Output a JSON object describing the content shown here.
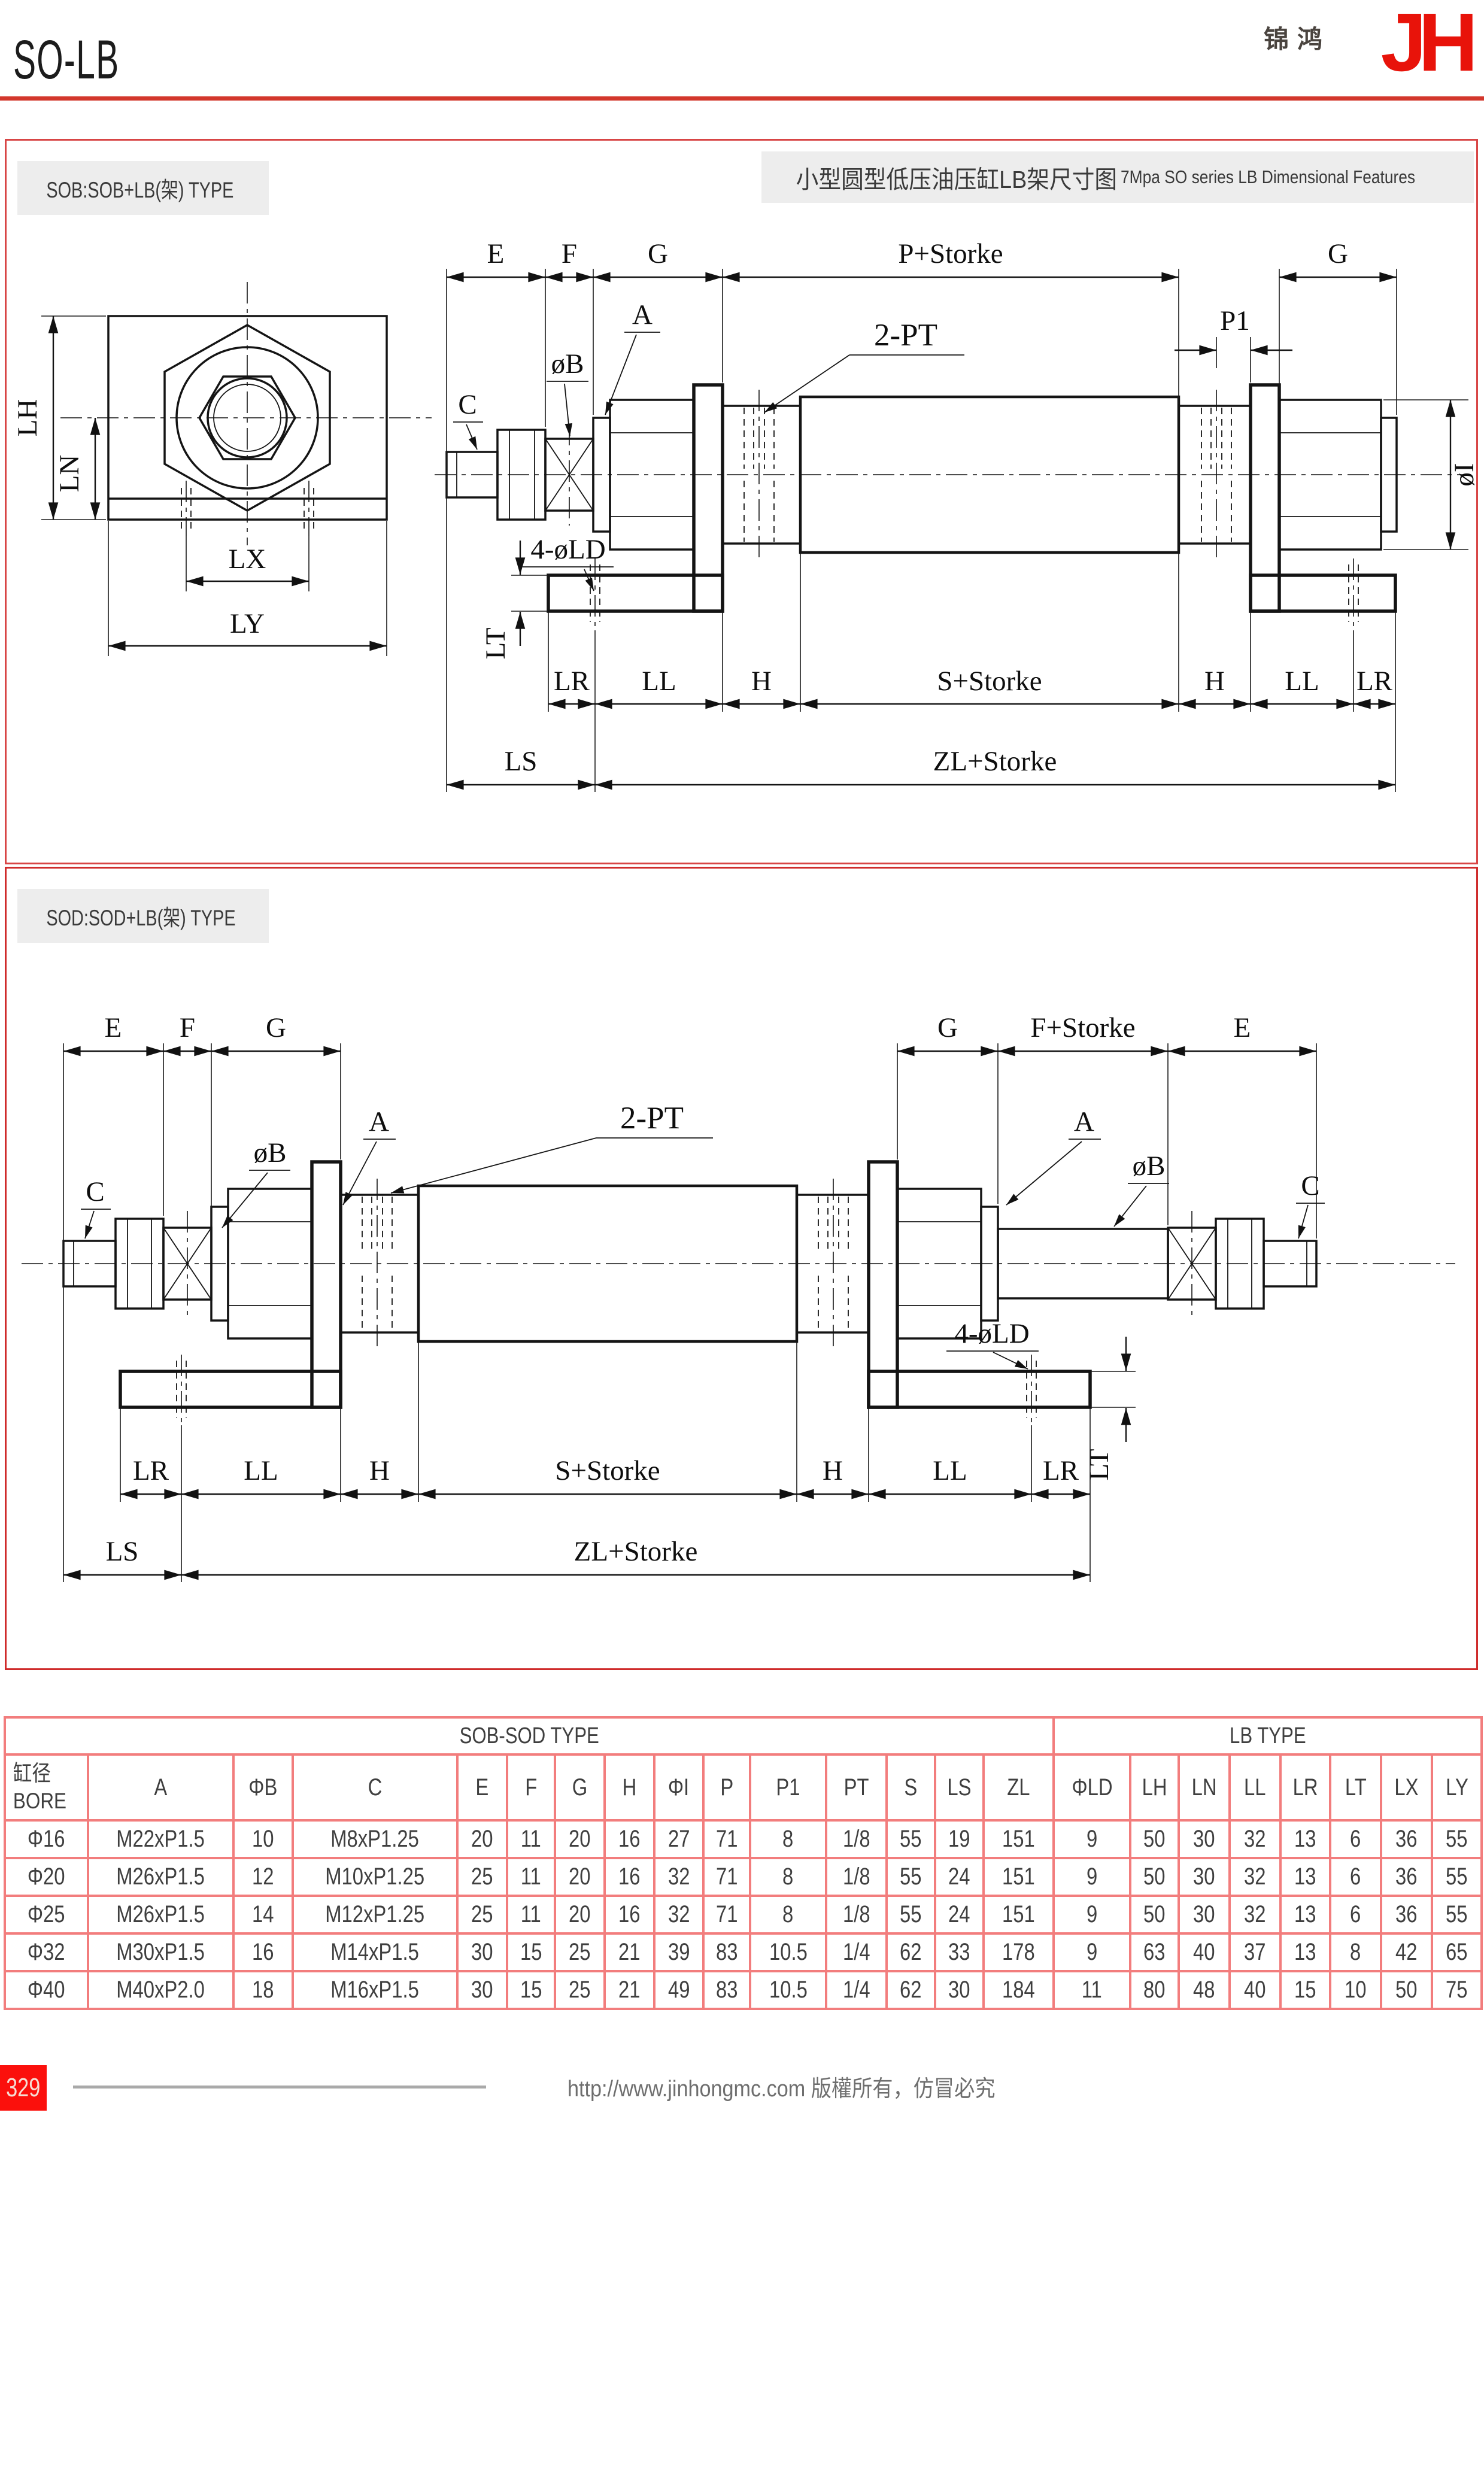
{
  "page": {
    "title": "SO-LB"
  },
  "logo": {
    "cn": "锦鸿",
    "latin": "JH"
  },
  "sections": {
    "sob": {
      "label": "SOB:SOB+LB(架) TYPE",
      "title_cn": "小型圆型低压油压缸LB架尺寸图",
      "title_en": "7Mpa SO series LB Dimensional Features"
    },
    "sod": {
      "label": "SOD:SOD+LB(架) TYPE"
    }
  },
  "dims": {
    "e": "E",
    "f": "F",
    "g": "G",
    "h": "H",
    "a": "A",
    "c": "C",
    "phi_b": "øB",
    "phi_i": "øI",
    "two_pt": "2-PT",
    "p1": "P1",
    "p_storke": "P+Storke",
    "f_storke": "F+Storke",
    "s_storke": "S+Storke",
    "zl_storke": "ZL+Storke",
    "four_phi_ld": "4-øLD",
    "lt": "LT",
    "lr": "LR",
    "ll": "LL",
    "ls": "LS",
    "lh": "LH",
    "ln": "LN",
    "lx": "LX",
    "ly": "LY"
  },
  "table": {
    "group_left": "SOB-SOD TYPE",
    "group_right": "LB TYPE",
    "bore_header": {
      "cn": "缸径",
      "en": "BORE"
    },
    "columns": [
      "A",
      "ΦB",
      "C",
      "E",
      "F",
      "G",
      "H",
      "ΦI",
      "P",
      "P1",
      "PT",
      "S",
      "LS",
      "ZL",
      "ΦLD",
      "LH",
      "LN",
      "LL",
      "LR",
      "LT",
      "LX",
      "LY"
    ],
    "rows": [
      [
        "Φ16",
        "M22xP1.5",
        "10",
        "M8xP1.25",
        "20",
        "11",
        "20",
        "16",
        "27",
        "71",
        "8",
        "1/8",
        "55",
        "19",
        "151",
        "9",
        "50",
        "30",
        "32",
        "13",
        "6",
        "36",
        "55"
      ],
      [
        "Φ20",
        "M26xP1.5",
        "12",
        "M10xP1.25",
        "25",
        "11",
        "20",
        "16",
        "32",
        "71",
        "8",
        "1/8",
        "55",
        "24",
        "151",
        "9",
        "50",
        "30",
        "32",
        "13",
        "6",
        "36",
        "55"
      ],
      [
        "Φ25",
        "M26xP1.5",
        "14",
        "M12xP1.25",
        "25",
        "11",
        "20",
        "16",
        "32",
        "71",
        "8",
        "1/8",
        "55",
        "24",
        "151",
        "9",
        "50",
        "30",
        "32",
        "13",
        "6",
        "36",
        "55"
      ],
      [
        "Φ32",
        "M30xP1.5",
        "16",
        "M14xP1.5",
        "30",
        "15",
        "25",
        "21",
        "39",
        "83",
        "10.5",
        "1/4",
        "62",
        "33",
        "178",
        "9",
        "63",
        "40",
        "37",
        "13",
        "8",
        "42",
        "65"
      ],
      [
        "Φ40",
        "M40xP2.0",
        "18",
        "M16xP1.5",
        "30",
        "15",
        "25",
        "21",
        "49",
        "83",
        "10.5",
        "1/4",
        "62",
        "30",
        "184",
        "11",
        "80",
        "48",
        "40",
        "15",
        "10",
        "50",
        "75"
      ]
    ]
  },
  "footer": {
    "page_number": "329",
    "copyright": "http://www.jinhongmc.com 版權所有，仿冒必究"
  },
  "colors": {
    "brand_red": "#e8130a",
    "rule_red": "#d3372c",
    "table_border": "#f27d7d",
    "label_bg": "#ededed"
  }
}
